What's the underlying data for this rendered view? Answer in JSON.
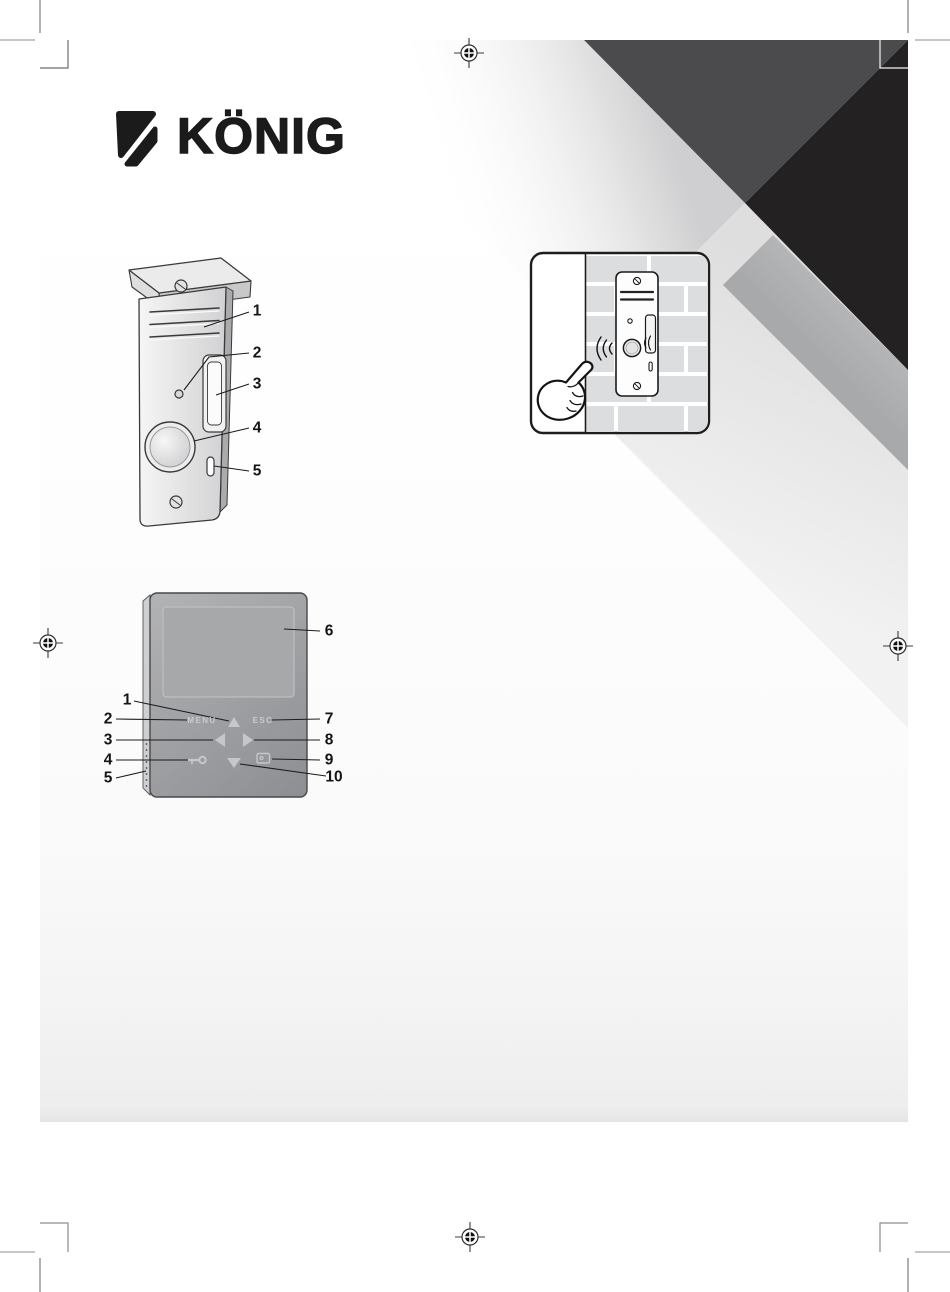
{
  "brand": {
    "logo_text": "KÖNIG"
  },
  "door_station_diagram": {
    "callouts": [
      "1",
      "2",
      "3",
      "4",
      "5"
    ]
  },
  "monitor_diagram": {
    "menu_label": "MENU",
    "esc_label": "ESC",
    "callouts_left": [
      "1",
      "2",
      "3",
      "4",
      "5"
    ],
    "callouts_right": [
      "6",
      "7",
      "8",
      "9",
      "10"
    ]
  },
  "icons": {
    "monitor_buttons": [
      "up-arrow-icon",
      "left-arrow-icon",
      "right-arrow-icon",
      "down-arrow-icon",
      "key-unlock-icon",
      "call-monitor-icon"
    ],
    "door_station_parts": [
      "camera-lens",
      "louver-vents",
      "microphone-hole",
      "name-card-slot",
      "call-button",
      "speaker-slot",
      "screw"
    ],
    "illustration_parts": [
      "pointing-hand",
      "doorbell-unit",
      "sound-waves",
      "brick-wall"
    ]
  },
  "colors": {
    "design_dark_gray": "#4b4b4d",
    "design_black": "#242122",
    "design_mid_gray": "#b1b2b4",
    "design_light_gray": "#e2e2e4",
    "monitor_body": "#9b9c9e",
    "monitor_screen": "#a7a8aa",
    "monitor_label": "#c9cacc",
    "line_art": "#2b2b2d"
  }
}
